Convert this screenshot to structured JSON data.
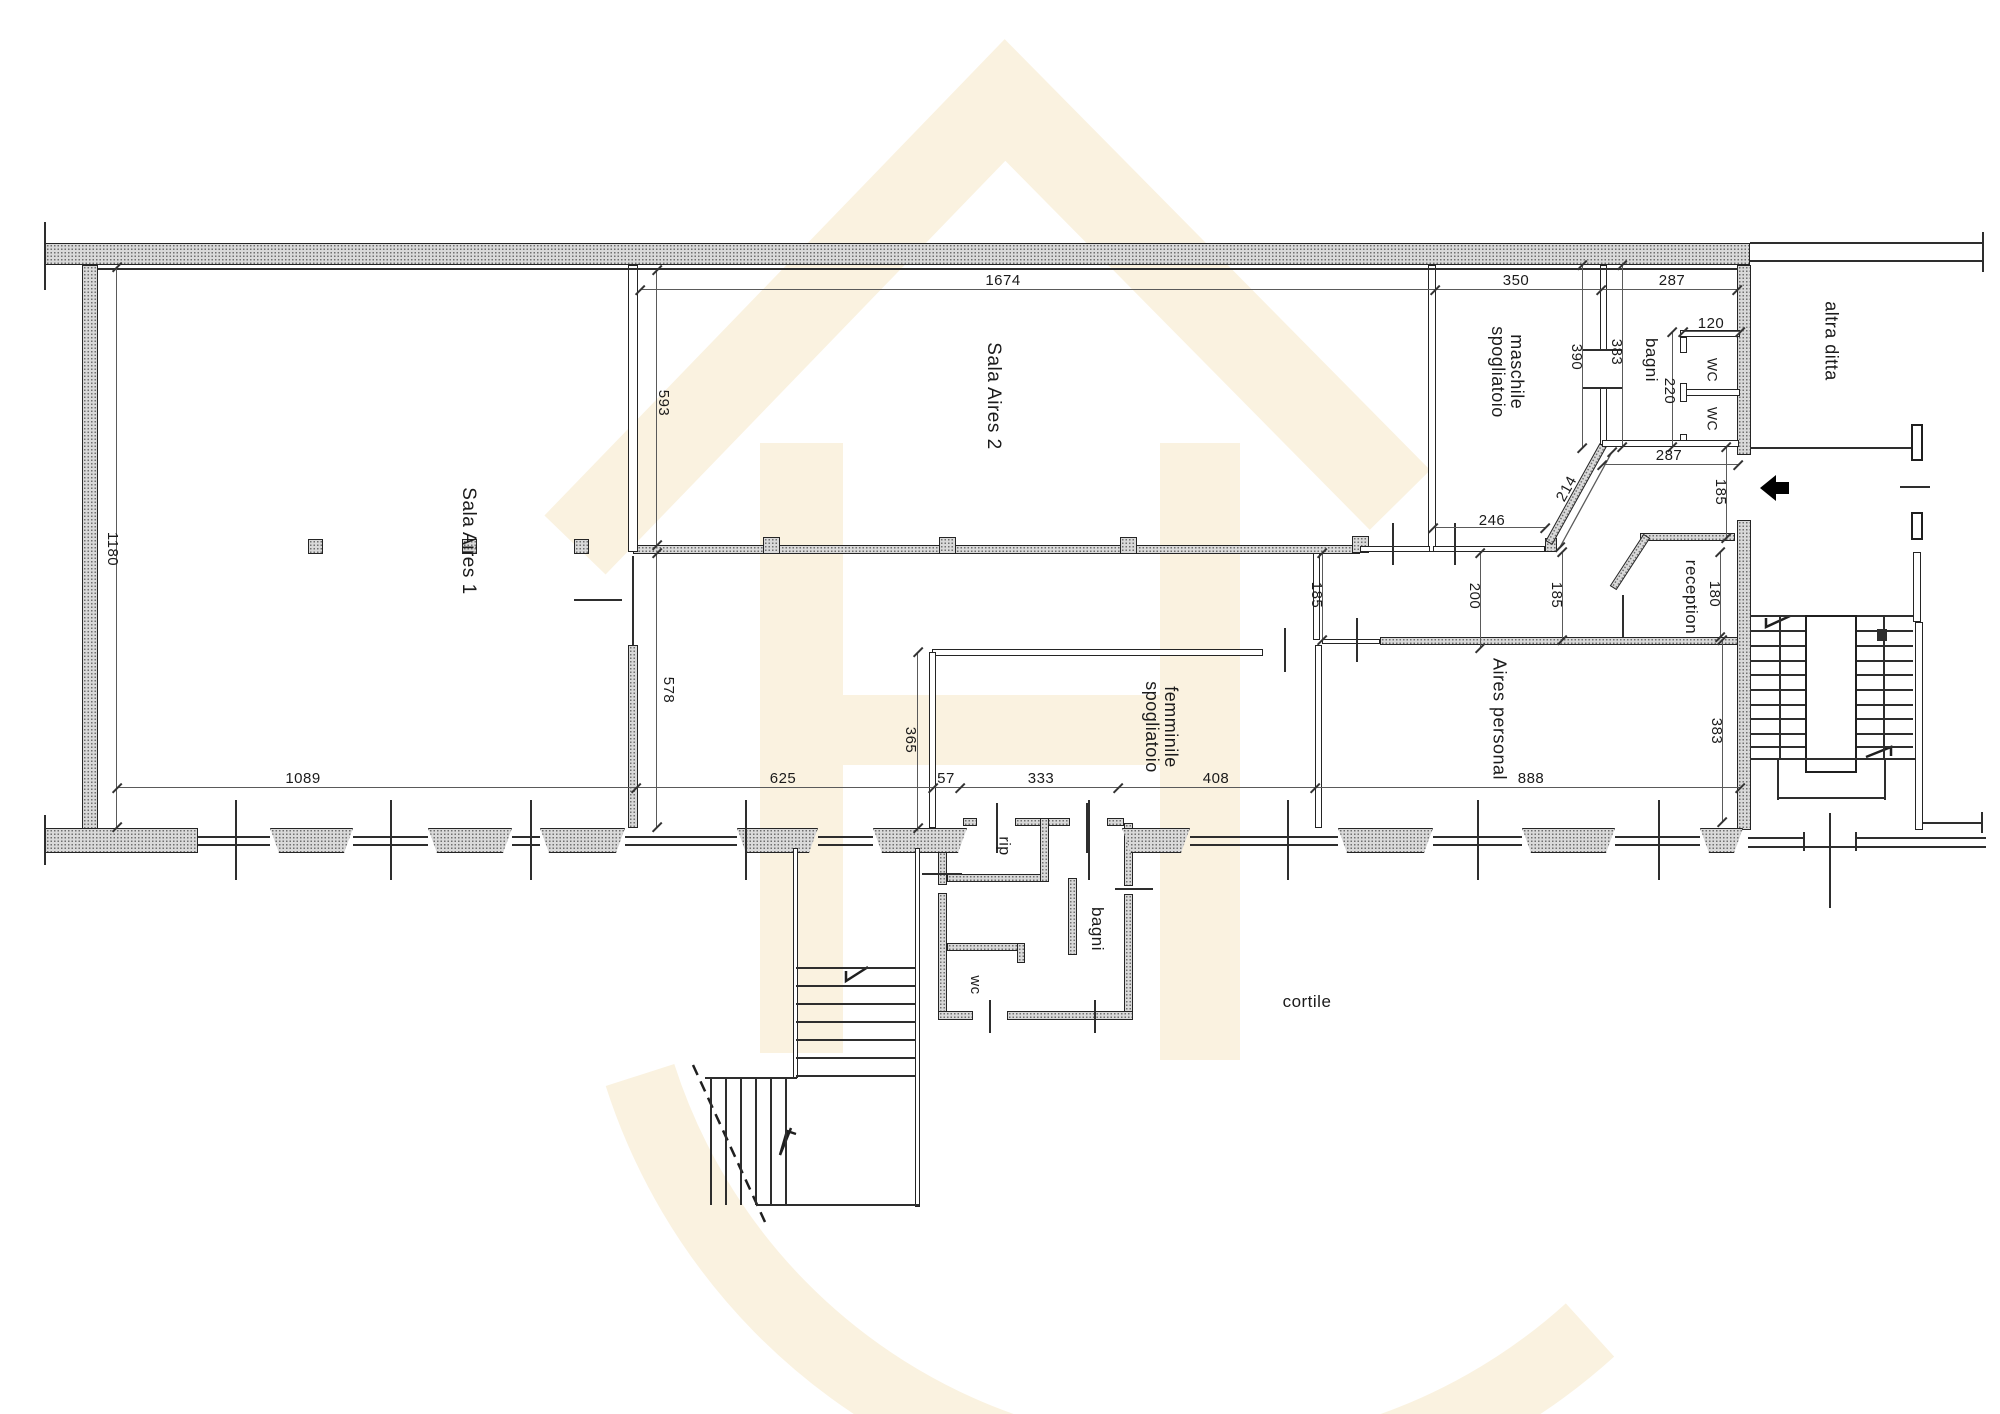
{
  "drawing": {
    "type": "floor-plan",
    "language": "it",
    "background_watermark_color": "#faf2e0",
    "wall_fill_color": "#d9d9d9",
    "line_color": "#2e2e2e"
  },
  "labels": [
    {
      "id": "sala-aires-1",
      "text": "Sala Aires 1",
      "kind": "room"
    },
    {
      "id": "sala-aires-2",
      "text": "Sala Aires 2",
      "kind": "room"
    },
    {
      "id": "spogliatoio-maschile",
      "text": "spogliatoio\nmaschile",
      "kind": "room"
    },
    {
      "id": "bagni-top",
      "text": "bagni",
      "kind": "room"
    },
    {
      "id": "wc-top-1",
      "text": "WC",
      "kind": "room"
    },
    {
      "id": "wc-top-2",
      "text": "WC",
      "kind": "room"
    },
    {
      "id": "altra-ditta",
      "text": "altra ditta",
      "kind": "room"
    },
    {
      "id": "reception",
      "text": "reception",
      "kind": "room"
    },
    {
      "id": "spogliatoio-femminile",
      "text": "spogliatoio\nfemminile",
      "kind": "room"
    },
    {
      "id": "aires-personal",
      "text": "Aires personal",
      "kind": "room"
    },
    {
      "id": "rip",
      "text": "rip",
      "kind": "room"
    },
    {
      "id": "bagni-annex",
      "text": "bagni",
      "kind": "room"
    },
    {
      "id": "wc-annex",
      "text": "wc",
      "kind": "room"
    },
    {
      "id": "cortile",
      "text": "cortile",
      "kind": "area"
    },
    {
      "id": "dim-1674",
      "text": "1674",
      "kind": "dimension"
    },
    {
      "id": "dim-350",
      "text": "350",
      "kind": "dimension"
    },
    {
      "id": "dim-287-top",
      "text": "287",
      "kind": "dimension"
    },
    {
      "id": "dim-593",
      "text": "593",
      "kind": "dimension"
    },
    {
      "id": "dim-1180",
      "text": "1180",
      "kind": "dimension"
    },
    {
      "id": "dim-578",
      "text": "578",
      "kind": "dimension"
    },
    {
      "id": "dim-1089",
      "text": "1089",
      "kind": "dimension"
    },
    {
      "id": "dim-625",
      "text": "625",
      "kind": "dimension"
    },
    {
      "id": "dim-57",
      "text": "57",
      "kind": "dimension"
    },
    {
      "id": "dim-333",
      "text": "333",
      "kind": "dimension"
    },
    {
      "id": "dim-408",
      "text": "408",
      "kind": "dimension"
    },
    {
      "id": "dim-888",
      "text": "888",
      "kind": "dimension"
    },
    {
      "id": "dim-365",
      "text": "365",
      "kind": "dimension"
    },
    {
      "id": "dim-185-corridor-left",
      "text": "185",
      "kind": "dimension"
    },
    {
      "id": "dim-200",
      "text": "200",
      "kind": "dimension"
    },
    {
      "id": "dim-185-corridor-right",
      "text": "185",
      "kind": "dimension"
    },
    {
      "id": "dim-246",
      "text": "246",
      "kind": "dimension"
    },
    {
      "id": "dim-214",
      "text": "214",
      "kind": "dimension"
    },
    {
      "id": "dim-390",
      "text": "390",
      "kind": "dimension"
    },
    {
      "id": "dim-383-bagni",
      "text": "383",
      "kind": "dimension"
    },
    {
      "id": "dim-120",
      "text": "120",
      "kind": "dimension"
    },
    {
      "id": "dim-220",
      "text": "220",
      "kind": "dimension"
    },
    {
      "id": "dim-287-bottom",
      "text": "287",
      "kind": "dimension"
    },
    {
      "id": "dim-185-entrance",
      "text": "185",
      "kind": "dimension"
    },
    {
      "id": "dim-180",
      "text": "180",
      "kind": "dimension"
    },
    {
      "id": "dim-383-stair",
      "text": "383",
      "kind": "dimension"
    }
  ]
}
